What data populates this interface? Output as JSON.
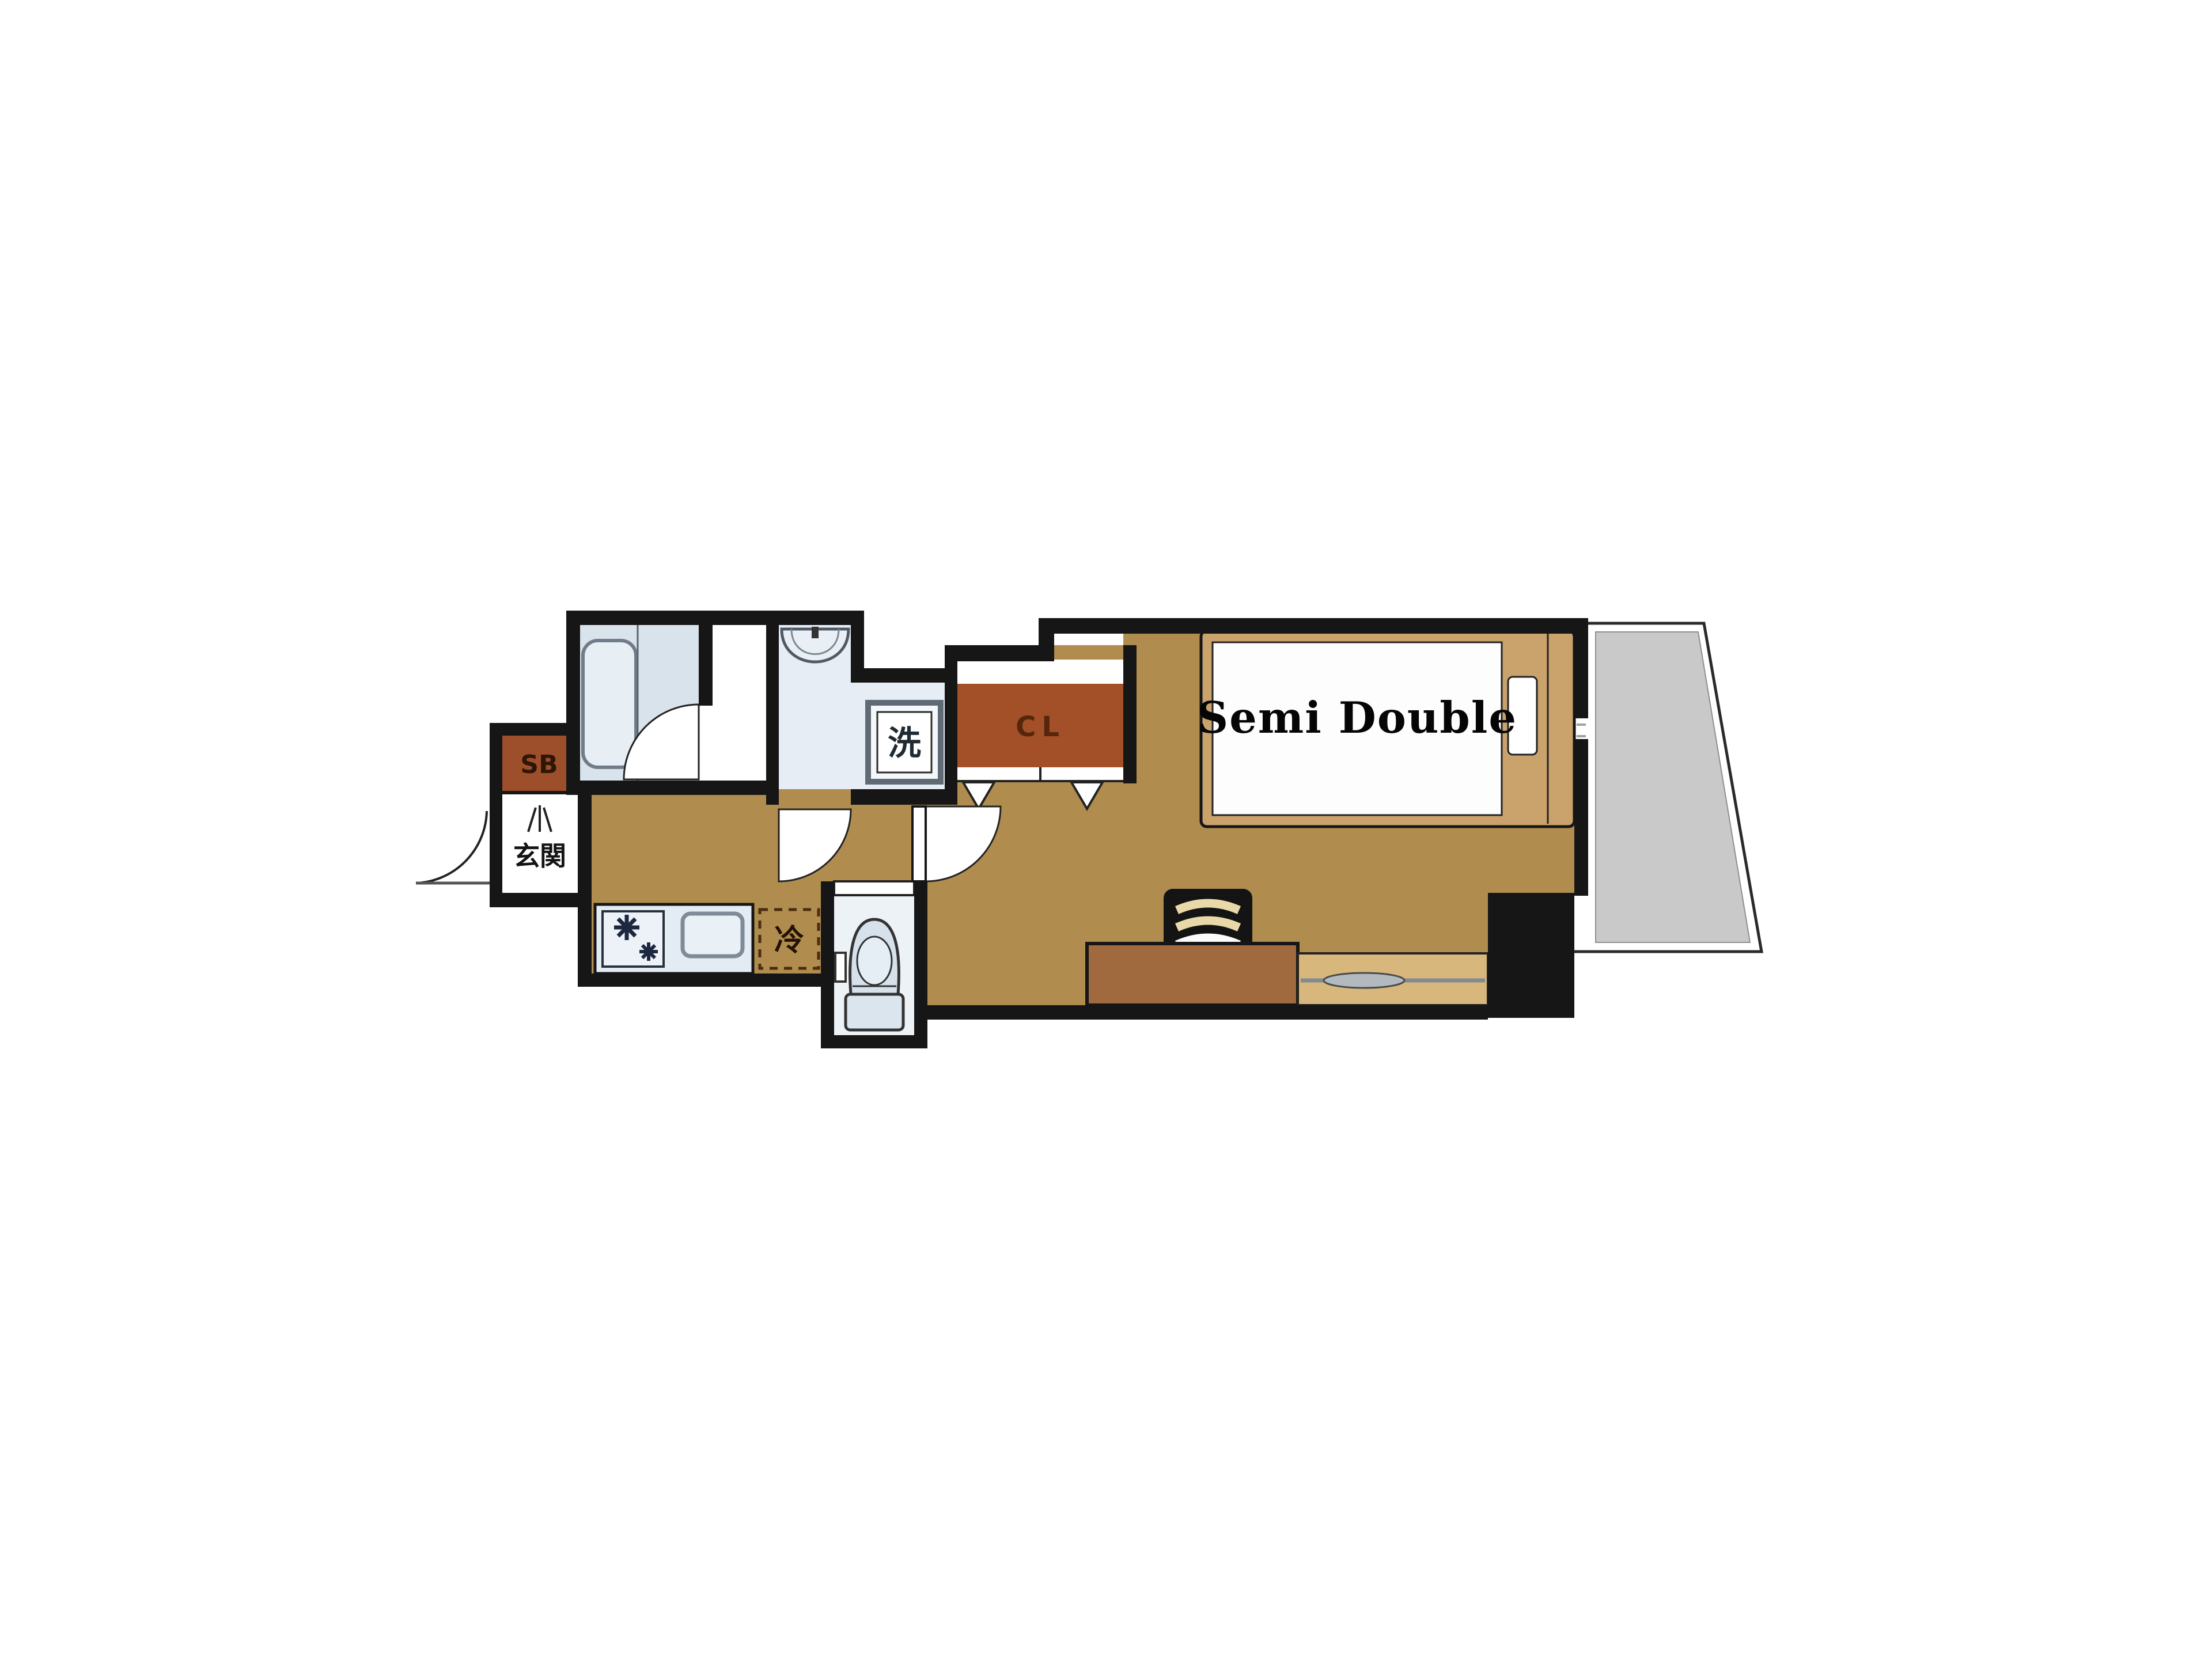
{
  "plan": {
    "bed_label": "Semi Double",
    "closet_label": "CL",
    "shoe_box_label": "SB",
    "entrance_label": "玄関",
    "washing_machine_label": "洗",
    "refrigerator_label": "冷"
  },
  "colors": {
    "wall": "#161616",
    "floor": "#b08c4e",
    "closet": "#a34f28",
    "shoe_box": "#9c4f2a",
    "fixture_fill": "#e7eef4",
    "fixture_stroke": "#5f6a74",
    "balcony": "#c9c9c9",
    "bed_frame": "#c9a36b",
    "desk": "#a06a3e",
    "window_sill": "#d7b77c"
  }
}
